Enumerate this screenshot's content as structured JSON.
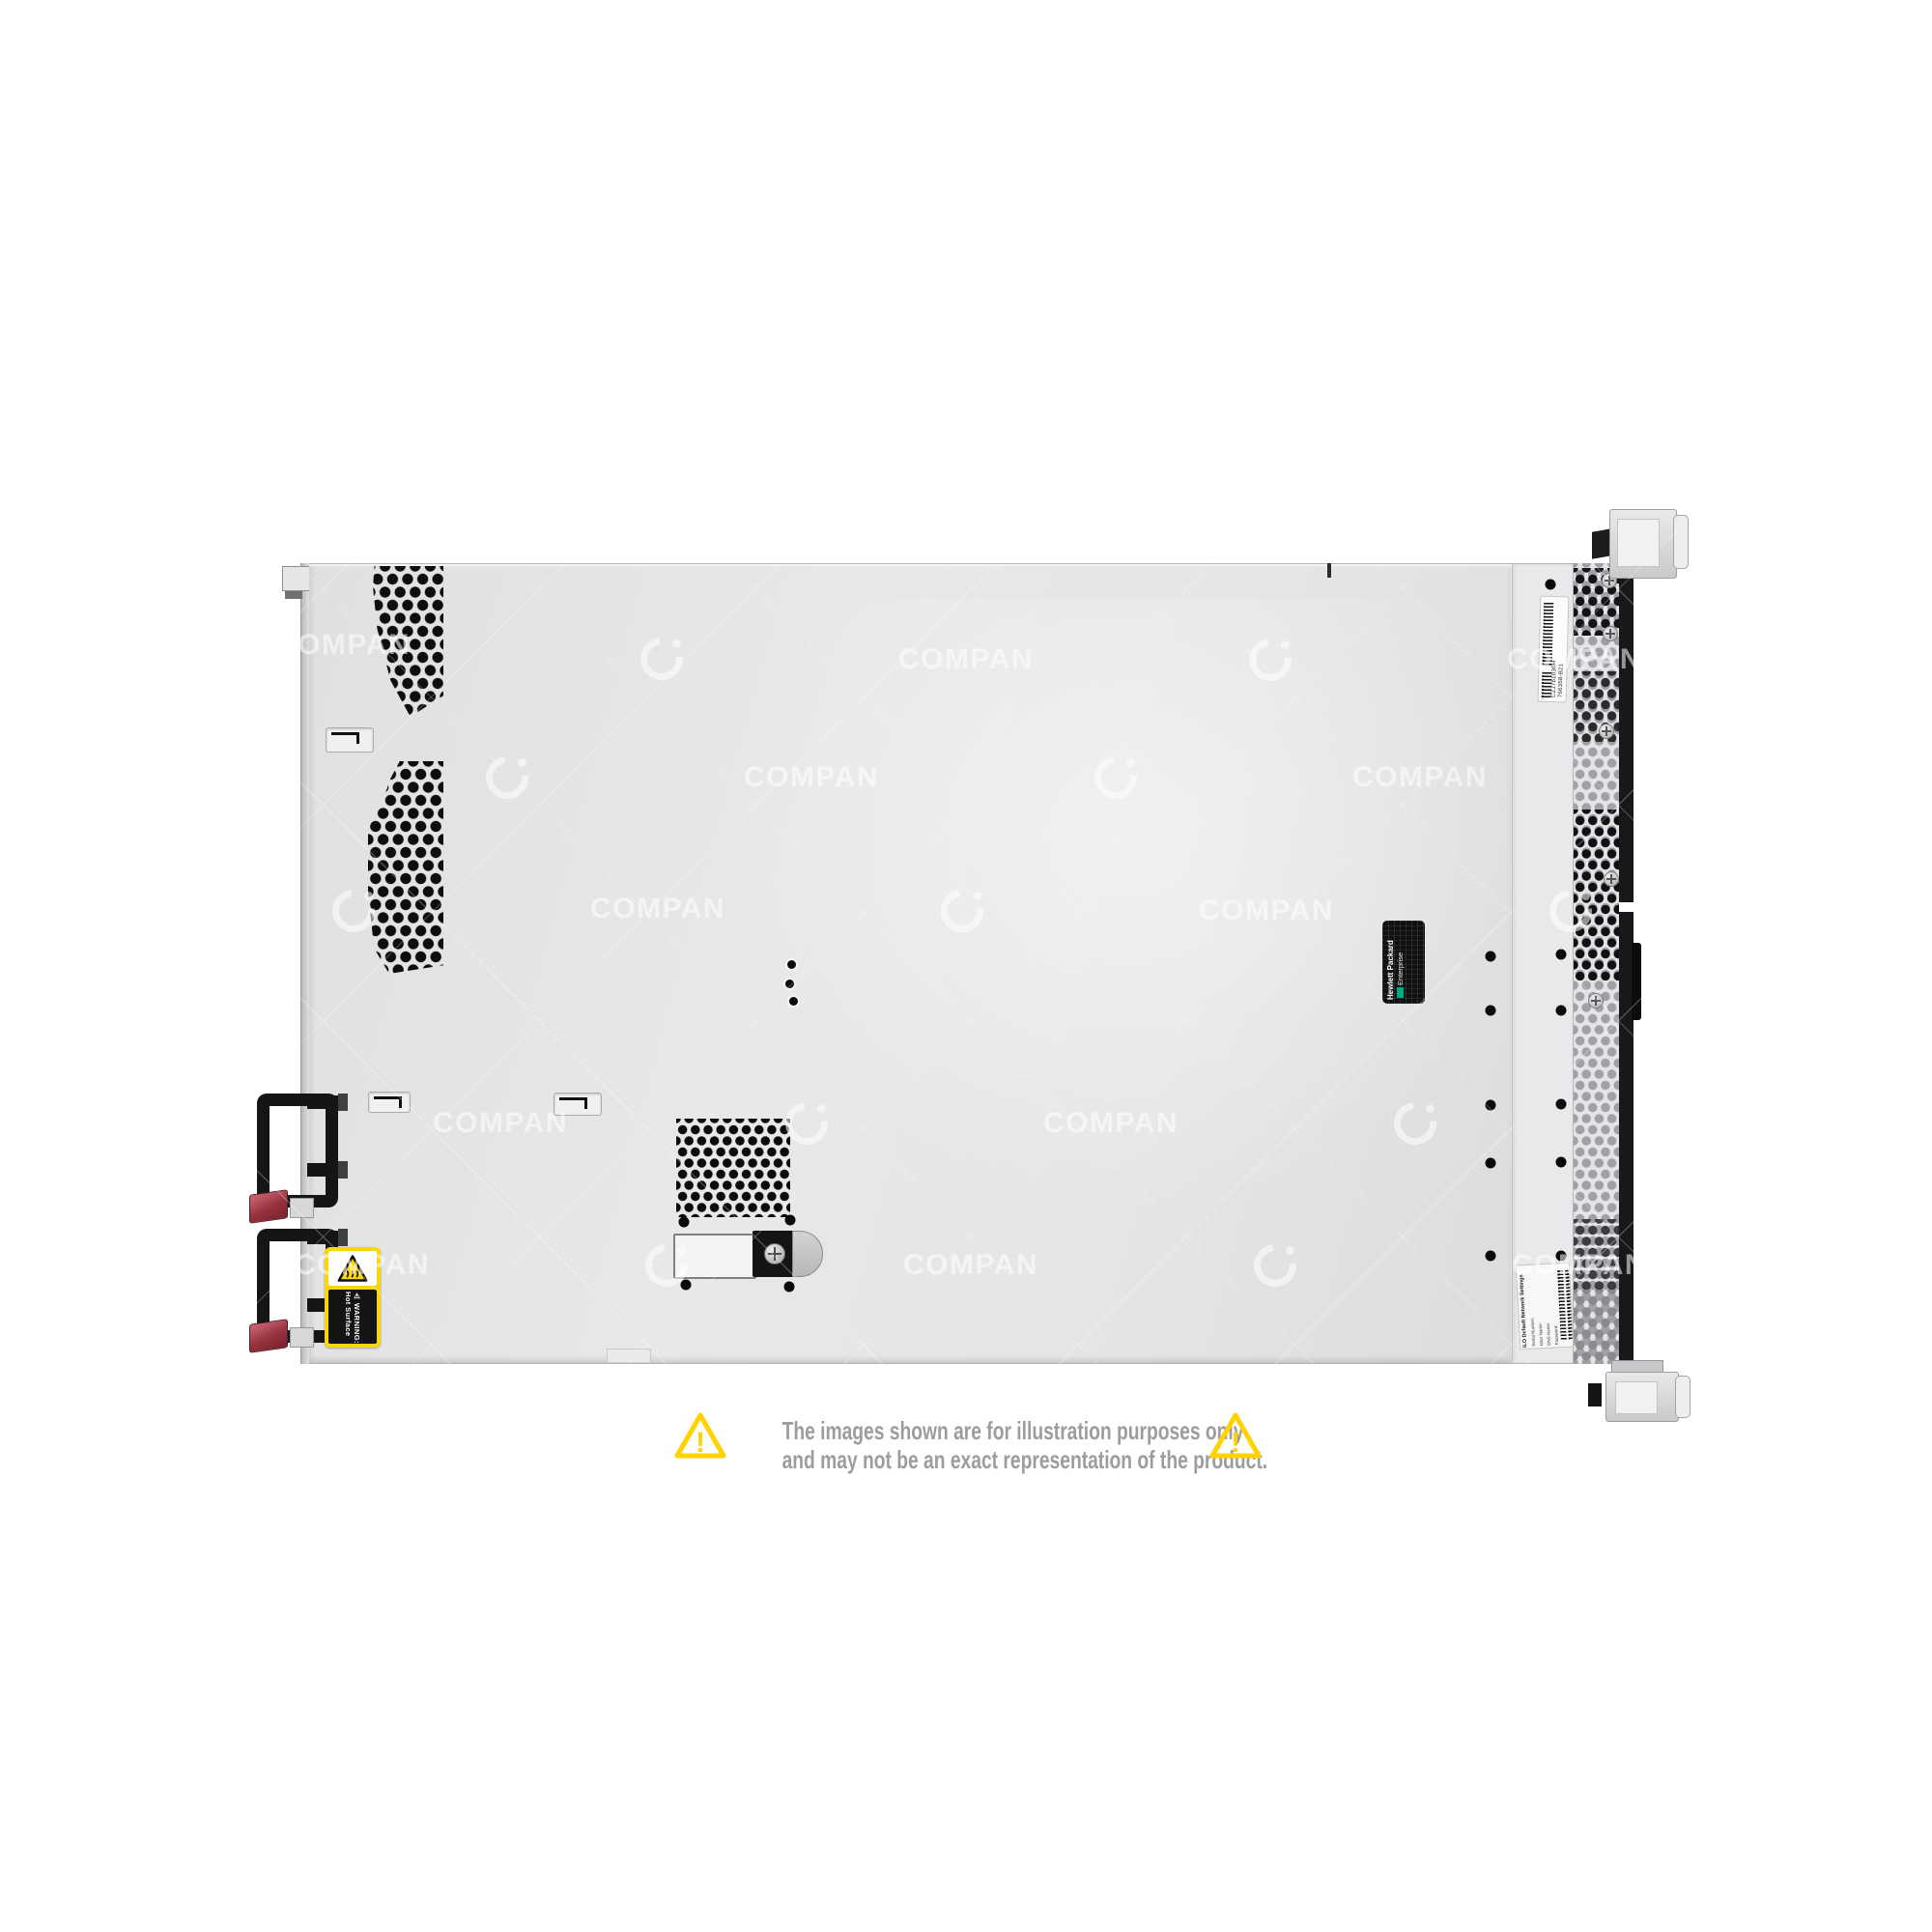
{
  "meta": {
    "alt": "Top view of a 1U rack server chassis, product photo",
    "background": "#ffffff"
  },
  "watermark": {
    "text": "COMPAN"
  },
  "icons": {
    "exclamation": "!",
    "warning_glyph": "⚠"
  },
  "labels": {
    "warning": {
      "heading": "WARNING:",
      "text": "Hot Surface",
      "bg": "#f8d60b"
    },
    "brand": {
      "line1": "Hewlett Packard",
      "line2": "Enterprise",
      "accent": "#01a982"
    },
    "service": {
      "serial": "CZJ761030H",
      "part": "766358-B21"
    },
    "ilo": {
      "title": "iLO Default Network Settings",
      "fields": [
        "Serial Number:",
        "User Name:",
        "DNS Name:",
        "Password:"
      ]
    }
  },
  "disclaimer": {
    "line1": "The images shown are for illustration purposes only",
    "line2": "and may not be an exact representation of the product.",
    "text_color": "#9d9d9d",
    "triangle_color": "#ffd200"
  },
  "colors": {
    "chassis": "#e4e5e7",
    "vent_hole": "#0e0e0f",
    "front_face_black": "#17181a",
    "psu_latch_red": "#96323e"
  }
}
